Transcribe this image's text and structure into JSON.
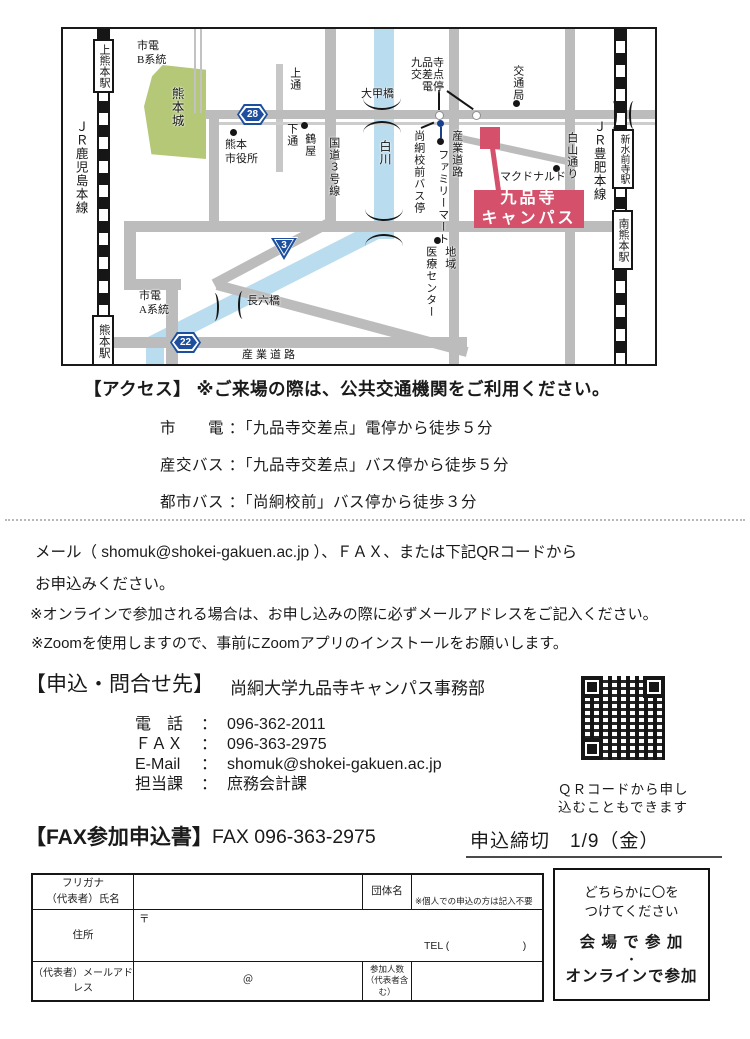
{
  "map": {
    "badges": {
      "b28": "28",
      "b3": "3",
      "b22": "22"
    },
    "stations": {
      "kamikumamoto": "上熊本駅",
      "kumamoto": "熊本駅",
      "shinsuizenji": "新水前寺駅",
      "minamikumamoto": "南熊本駅"
    },
    "labels": {
      "jr_kagoshima": "ＪＲ鹿児島本線",
      "jr_hohi": "ＪＲ豊肥本線",
      "tram_b": "市電\nB系統",
      "tram_a": "市電\nA系統",
      "castle": "熊本城",
      "kamitori": "上通",
      "shimotori": "下通",
      "tsuruya": "鶴屋",
      "city_hall": "熊本\n市役所",
      "route3": "国道３号線",
      "shirakawa": "白川",
      "taiko_bridge": "大甲橋",
      "tram_stop": "九品寺\n交差点\n電停",
      "shokei_bus": "尚絅校前バス停",
      "familymart": "ファミリーマート",
      "sangyo_v": "産業道路",
      "kotsukyoku": "交通局",
      "hakuzan": "白山通り",
      "mcdonalds": "マクドナルド",
      "chiiki": "地域",
      "iryo_center": "医療センター",
      "choroku_bridge": "長六橋",
      "sangyo_h": "産業道路",
      "campus_line1": "九品寺",
      "campus_line2": "キャンパス"
    }
  },
  "access": {
    "header": "【アクセス】 ※ご来場の際は、公共交通機関をご利用ください。",
    "lines": [
      "市　　電 ：「九品寺交差点」電停から徒歩５分",
      "産交バス ：「九品寺交差点」バス停から徒歩５分",
      "都市バス ：「尚絅校前」バス停から徒歩３分"
    ]
  },
  "apply": {
    "line1": "メール（ shomuk@shokei-gakuen.ac.jp ）、ＦＡＸ、または下記QRコードから",
    "line2": "お申込みください。",
    "note1": "※オンラインで参加される場合は、お申し込みの際に必ずメールアドレスをご記入ください。",
    "note2": "※Zoomを使用しますので、事前にZoomアプリのインストールをお願いします。"
  },
  "contact": {
    "header_bracket": "【申込・問合せ先】",
    "header_org": "尚絅大学九品寺キャンパス事務部",
    "colon": "：",
    "rows": [
      {
        "label": "電　話",
        "value": "096-362-2011"
      },
      {
        "label": "ＦＡＸ",
        "value": "096-363-2975"
      },
      {
        "label": "E-Mail",
        "value": "shomuk@shokei-gakuen.ac.jp"
      },
      {
        "label": "担当課",
        "value": "庶務会計課"
      }
    ]
  },
  "qr": {
    "caption1": "ＱＲコードから申し",
    "caption2": "込むこともできます"
  },
  "fax": {
    "header_bracket": "【FAX参加申込書】",
    "fax_number": "FAX 096-363-2975",
    "deadline": "申込締切　1/9（金）"
  },
  "form": {
    "furigana_l1": "フリガナ",
    "furigana_l2": "（代表者）氏名",
    "dantai": "団体名",
    "dantai_note": "※個人での申込の方は記入不要",
    "jusho": "住所",
    "yubin": "〒",
    "tel": "TEL (　　　　　　　)",
    "mail_label": "（代表者）メールアドレス",
    "at": "＠",
    "sanka_l1": "参加人数",
    "sanka_l2": "（代表者含む）",
    "choice_note1": "どちらかに〇を",
    "choice_note2": "つけてください",
    "choice1": "会 場 で 参 加",
    "dot": "・",
    "choice2": "オンラインで参加"
  },
  "colors": {
    "campus_red": "#d4506b",
    "road_gray": "#bcbcbc",
    "river_blue": "#b9dcee",
    "castle_green": "#b5c877",
    "badge_blue": "#1d4f9e",
    "busstop_blue": "#1a3f8f"
  }
}
